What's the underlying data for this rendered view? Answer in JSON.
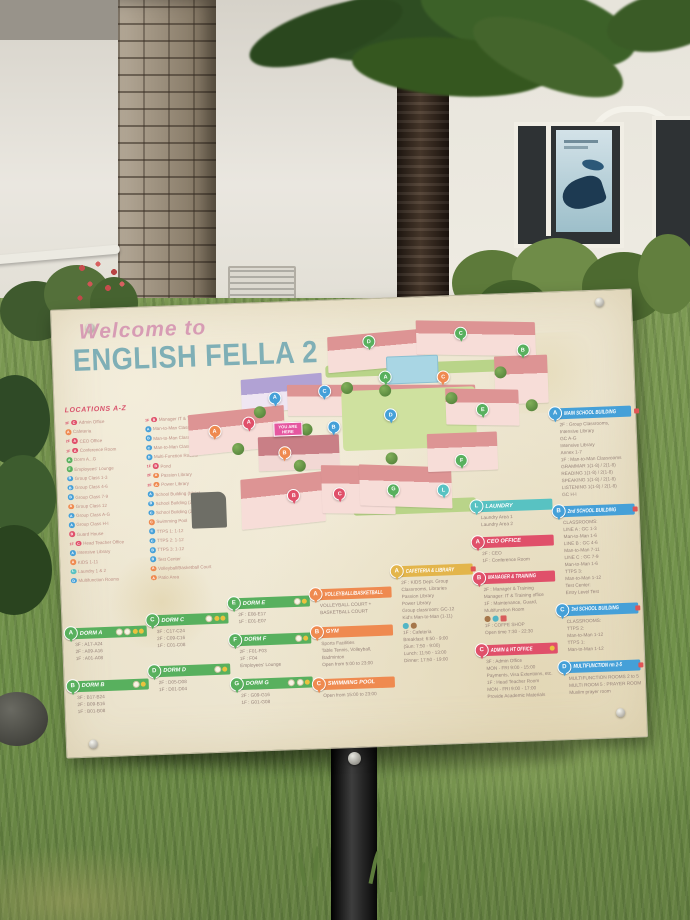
{
  "colors": {
    "green": "#58b05e",
    "blue": "#45a0d8",
    "red": "#e0506a",
    "orange": "#ef8a50",
    "gold": "#e3b54b",
    "teal": "#58c2c2",
    "panel_cream": "#efe8d2",
    "title_teal": "#7fafb6",
    "welcome_pink": "#d79cb4"
  },
  "sign": {
    "welcome": "Welcome to",
    "title": "ENGLISH FELLA 2",
    "locations": {
      "heading": "LOCATIONS A-Z",
      "col1": [
        {
          "f": "3F",
          "l": "C",
          "c": "r",
          "t": "Admin Office"
        },
        {
          "l": "A",
          "c": "o",
          "t": "Cafeteria"
        },
        {
          "f": "2F",
          "l": "A",
          "c": "r",
          "t": "CEO Office"
        },
        {
          "f": "1F",
          "l": "A",
          "c": "r",
          "t": "Conference Room"
        },
        {
          "l": "A",
          "c": "g",
          "t": "Dorm A...G"
        },
        {
          "l": "F",
          "c": "g",
          "t": "Employees' Lounge"
        },
        {
          "l": "B",
          "c": "b",
          "t": "Group Class 1-3"
        },
        {
          "l": "B",
          "c": "b",
          "t": "Group Class 4-6"
        },
        {
          "l": "B",
          "c": "b",
          "t": "Group Class 7-9"
        },
        {
          "l": "A",
          "c": "o",
          "t": "Group Class 12"
        },
        {
          "l": "A",
          "c": "b",
          "t": "Group Class A-G"
        },
        {
          "l": "A",
          "c": "b",
          "t": "Group Class H-I"
        },
        {
          "l": "B",
          "c": "r",
          "t": "Guard House"
        },
        {
          "f": "1F",
          "l": "C",
          "c": "r",
          "t": "Head Teacher Office"
        },
        {
          "l": "A",
          "c": "b",
          "t": "Intensive Library"
        },
        {
          "l": "A",
          "c": "o",
          "t": "KIDS 1-11"
        },
        {
          "l": "L",
          "c": "t",
          "t": "Laundry 1 & 2"
        },
        {
          "l": "D",
          "c": "b",
          "t": "Multifunction Rooms"
        }
      ],
      "col2": [
        {
          "f": "1F",
          "l": "B",
          "c": "r",
          "t": "Manager IT & Training Office"
        },
        {
          "l": "A",
          "c": "b",
          "t": "Man-to-Man Class 1-6"
        },
        {
          "l": "B",
          "c": "b",
          "t": "Man-to-Man Class 7-11"
        },
        {
          "l": "C",
          "c": "b",
          "t": "Man-to-Man Class 1-6"
        },
        {
          "l": "D",
          "c": "b",
          "t": "Multi-Function Rooms"
        },
        {
          "f": "1F",
          "l": "B",
          "c": "r",
          "t": "Pond"
        },
        {
          "f": "2F",
          "l": "A",
          "c": "o",
          "t": "Passion Library"
        },
        {
          "f": "2F",
          "l": "A",
          "c": "o",
          "t": "Power Library"
        },
        {
          "l": "A",
          "c": "b",
          "t": "School Building (Main)"
        },
        {
          "l": "B",
          "c": "b",
          "t": "School Building (2nd)"
        },
        {
          "l": "C",
          "c": "b",
          "t": "School Building (3rd)"
        },
        {
          "l": "C",
          "c": "o",
          "t": "Swimming Pool"
        },
        {
          "l": "C",
          "c": "b",
          "t": "TTPS 1: 1-12"
        },
        {
          "l": "C",
          "c": "b",
          "t": "TTPS 2: 1-12"
        },
        {
          "l": "B",
          "c": "b",
          "t": "TTPS 3: 1-12"
        },
        {
          "l": "B",
          "c": "b",
          "t": "Test Center"
        },
        {
          "l": "A",
          "c": "o",
          "t": "Volleyball/Basketball Court"
        },
        {
          "l": "A",
          "c": "o",
          "t": "Patio Area"
        }
      ]
    },
    "map": {
      "you_are_here": "YOU ARE HERE",
      "markers": [
        {
          "l": "D",
          "c": "g",
          "x": 50,
          "y": 5
        },
        {
          "l": "C",
          "c": "g",
          "x": 74,
          "y": 3
        },
        {
          "l": "B",
          "c": "g",
          "x": 90,
          "y": 11
        },
        {
          "l": "A",
          "c": "g",
          "x": 54,
          "y": 20
        },
        {
          "l": "E",
          "c": "g",
          "x": 79,
          "y": 35
        },
        {
          "l": "F",
          "c": "g",
          "x": 73,
          "y": 56
        },
        {
          "l": "G",
          "c": "g",
          "x": 55,
          "y": 67
        },
        {
          "l": "A",
          "c": "b",
          "x": 25,
          "y": 27
        },
        {
          "l": "C",
          "c": "b",
          "x": 38,
          "y": 25
        },
        {
          "l": "B",
          "c": "b",
          "x": 40,
          "y": 40
        },
        {
          "l": "D",
          "c": "b",
          "x": 55,
          "y": 36
        },
        {
          "l": "A",
          "c": "r",
          "x": 18,
          "y": 37
        },
        {
          "l": "B",
          "c": "r",
          "x": 29,
          "y": 68
        },
        {
          "l": "C",
          "c": "r",
          "x": 41,
          "y": 68
        },
        {
          "l": "A",
          "c": "o",
          "x": 9,
          "y": 40
        },
        {
          "l": "B",
          "c": "o",
          "x": 27,
          "y": 50
        },
        {
          "l": "C",
          "c": "o",
          "x": 69,
          "y": 21
        },
        {
          "l": "L",
          "c": "t",
          "x": 68,
          "y": 68
        }
      ]
    },
    "columns": [
      {
        "id": "col1",
        "boxes": [
          {
            "letter": "A",
            "theme": "green",
            "title": "DORM A",
            "hicons": [
              "light",
              "light",
              "gold",
              "gold"
            ],
            "lines": [
              "3F : A17-A24",
              "2F : A09-A16",
              "1F : A01-A08"
            ]
          },
          {
            "letter": "B",
            "theme": "green",
            "title": "DORM B",
            "hicons": [
              "light",
              "gold"
            ],
            "lines": [
              "3F : B17-B24",
              "2F : B09-B16",
              "1F : B01-B08"
            ]
          }
        ]
      },
      {
        "id": "col2",
        "boxes": [
          {
            "letter": "C",
            "theme": "green",
            "title": "DORM C",
            "hicons": [
              "light",
              "gold",
              "gold"
            ],
            "lines": [
              "3F : C17-C24",
              "2F : C09-C16",
              "1F : C01-C08"
            ]
          },
          {
            "letter": "D",
            "theme": "green",
            "title": "DORM D",
            "hicons": [
              "light",
              "gold"
            ],
            "lines": [
              "2F : D05-D08",
              "1F : D01-D04"
            ]
          }
        ]
      },
      {
        "id": "col3",
        "boxes": [
          {
            "letter": "E",
            "theme": "green",
            "title": "DORM E",
            "hicons": [
              "light",
              "gold"
            ],
            "lines": [
              "2F : E08-E17",
              "1F : E01-E07"
            ]
          },
          {
            "letter": "F",
            "theme": "green",
            "title": "DORM F",
            "hicons": [
              "light",
              "gold"
            ],
            "lines": [
              "2F : F01-F03",
              "1F : F04",
              "Employees' Lounge"
            ]
          },
          {
            "letter": "G",
            "theme": "green",
            "title": "DORM G",
            "hicons": [
              "light",
              "light",
              "gold"
            ],
            "lines": [
              "2F : G09-G16",
              "1F : G01-G08"
            ]
          }
        ]
      },
      {
        "id": "col4",
        "boxes": [
          {
            "letter": "A",
            "theme": "orange",
            "title": "VOLLEYBALL/BASKETBALL",
            "hicons": [],
            "lines": [
              "VOLLEYBALL COURT +",
              "BASKETBALL COURT"
            ]
          },
          {
            "letter": "B",
            "theme": "orange",
            "title": "GYM",
            "hicons": [],
            "lines": [
              "Sports Facilities",
              "Table Tennis, Volleyball,",
              "Badminton",
              "Open from 5:00 to 23:00"
            ]
          },
          {
            "letter": "C",
            "theme": "orange",
            "title": "SWIMMING POOL",
            "hicons": [],
            "lines": [
              "Open from 15:00 to 23:00"
            ]
          }
        ]
      },
      {
        "id": "col5",
        "boxes": [
          {
            "letter": "A",
            "theme": "gold",
            "title": "CAFETERIA & LIBRARY",
            "hicons": [
              "red"
            ],
            "lines": [
              "2F : KIDS Dept. Group",
              "Classrooms, Libraries",
              "Passion Library",
              "Power Library",
              "Group classroom: GC-12",
              "Kid's Man-to-Man (1-11)",
              "@icons:wifi,coffee",
              "1F : Cafeteria",
              "Breakfast:  6:50 - 9:00",
              "(Sun: 7:50 - 9:00)",
              "Lunch:  11:50 - 13:00",
              "Dinner:  17:50 - 19:00"
            ]
          }
        ]
      },
      {
        "id": "col6",
        "boxes": [
          {
            "letter": "L",
            "theme": "teal",
            "title": "LAUNDRY",
            "hicons": [],
            "lines": [
              "Laundry Area 1",
              "Laundry Area 2"
            ]
          },
          {
            "letter": "A",
            "theme": "red",
            "title": "CEO OFFICE",
            "hicons": [],
            "lines": [
              "2F : CEO",
              "1F : Conference Room"
            ]
          },
          {
            "letter": "B",
            "theme": "red",
            "title": "MANAGER & TRAINING",
            "hicons": [],
            "lines": [
              "2F : Manager & Training",
              "Manager: IT & Training office",
              "1F : Maintenance, Guard,",
              "Multifunction Room",
              "@icons:coffee,wifi,card",
              "1F : COFFE SHOP",
              "Open time 7:30 - 22:30"
            ]
          },
          {
            "letter": "C",
            "theme": "red",
            "title": "ADMIN & HT OFFICE",
            "hicons": [
              "gold"
            ],
            "lines": [
              "3F : Admin Office",
              "MON - FRI 9:00 - 15:00",
              "Payments, Visa Extentions, etc.",
              "1F : Head Teacher Room",
              "MON - FRI 9:00 - 17:00",
              "Provide Academic Materials"
            ]
          }
        ]
      },
      {
        "id": "col7",
        "boxes": [
          {
            "letter": "A",
            "theme": "blue",
            "title": "MAIN SCHOOL BUILDING",
            "hicons": [
              "red"
            ],
            "lines": [
              "2F : Group Classrooms,",
              "Intensive Library",
              "GC A-G",
              "Intensive Library",
              "Annex 1-7",
              "1F : Man-to-Man Classrooms",
              "GRAMMAR 1(1-8) / 2(1-8)",
              "READING 1(1-8) / 2(1-8)",
              "SPEAKING 1(1-8) / 2(1-8)",
              "LISTENING 1(1-8) / 2(1-8)",
              "GC H-I"
            ]
          },
          {
            "letter": "B",
            "theme": "blue",
            "title": "2nd SCHOOL BUILDING",
            "hicons": [
              "red"
            ],
            "lines": [
              "CLASSROOMS:",
              "LINE A : GC 1-3",
              "Man-to-Man 1-6",
              "LINE B : GC 4-6",
              "Man-to-Man 7-11",
              "LINE C : GC 7-9",
              "Man-to-Man 1-6",
              "TTPS 3:",
              "Man-to-Man 1-12",
              "Test Center:",
              "Entry Level Test"
            ]
          },
          {
            "letter": "C",
            "theme": "blue",
            "title": "3rd SCHOOL BUILDING",
            "hicons": [
              "red"
            ],
            "lines": [
              "CLASSROOMS:",
              "TTPS 2:",
              "Man-to-Man 1-12",
              "TTPS 1:",
              "Man-to-Man 1-12"
            ]
          },
          {
            "letter": "D",
            "theme": "blue",
            "title": "MULTIFUNCTION rm 2-5",
            "hicons": [
              "red"
            ],
            "lines": [
              "MULTIFUNCTION ROOMS 2 to 5",
              "MULTI ROOM 5 : PRAYER ROOM",
              "Muslim prayer room"
            ]
          }
        ]
      }
    ]
  }
}
